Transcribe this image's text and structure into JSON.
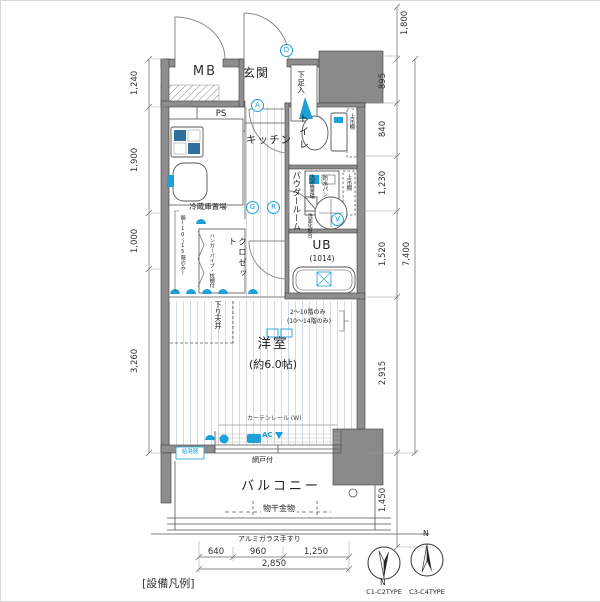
{
  "labels": {
    "mb": "MB",
    "genkan": "玄関",
    "shoe_box": "下足入",
    "ps": "PS",
    "kitchen": "キッチン",
    "toilet": "トイレ",
    "toilet_shelf": "上吊棚",
    "powder_room": "パウダールーム",
    "washer_space": "洗濯機置場",
    "washer_pan": "防水パン",
    "powder_shelf": "上吊棚",
    "vanity": "洗面化粧台",
    "fridge_space": "冷蔵庫置場",
    "closet": "クロゼット",
    "hanger_note": "ハンガーパイプ・枕棚付",
    "mirror_note": "鏡(10〜15階のみ)",
    "bath": "UB",
    "bath_size": "(1014)",
    "soffit": "下り天井",
    "main_room": "洋室",
    "main_room_size": "(約6.0帖)",
    "floor_note_1": "2〜10階のみ",
    "floor_note_2": "(10〜14階のみ)",
    "curtain_rail": "カーテンレール (W)",
    "ac": "AC",
    "screen_door": "網戸付",
    "water_heater": "給湯器",
    "balcony": "バルコニー",
    "drying_fixture": "物干金物",
    "handrail": "アルミガラス手すり"
  },
  "markers": {
    "d": "D",
    "a": "A",
    "g": "G",
    "r": "R",
    "v": "V"
  },
  "dimensions": {
    "left": [
      "1,240",
      "1,900",
      "1,000",
      "3,260"
    ],
    "right": [
      "1,800",
      "895",
      "840",
      "1,230",
      "1,520",
      "7,400",
      "2,915",
      "1,450"
    ],
    "bottom": [
      "640",
      "960",
      "1,250",
      "2,850"
    ]
  },
  "footer": {
    "legend": "[設備凡例]",
    "compass_1": "C1-C2TYPE",
    "compass_2": "C3-C4TYPE",
    "north_1": "N",
    "north_2": "N"
  },
  "colors": {
    "wall": "#8e8e8e",
    "pillar": "#8a8a8a",
    "accent_blue": "#1d9fd8",
    "line": "#555555"
  }
}
